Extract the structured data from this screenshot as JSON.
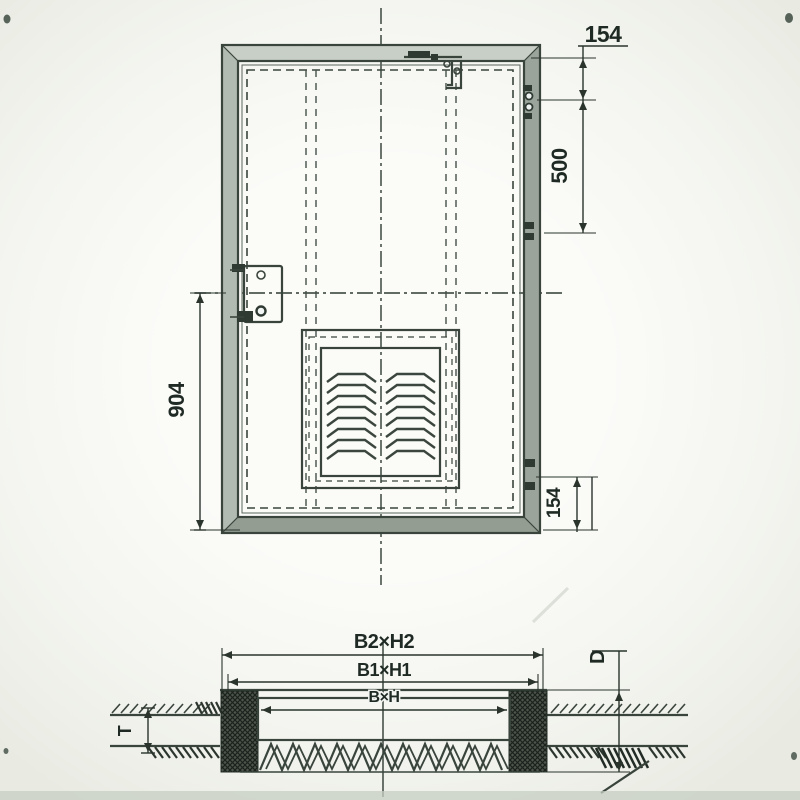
{
  "front_view": {
    "dim_top_right": "154",
    "dim_hinge_spacing": "500",
    "dim_left_height": "904",
    "dim_bottom_right": "154"
  },
  "section_view": {
    "dim_outer": "B2×H2",
    "dim_frame": "B1×H1",
    "dim_clear": "B×H",
    "dim_depth": "D",
    "dim_thickness": "T"
  }
}
